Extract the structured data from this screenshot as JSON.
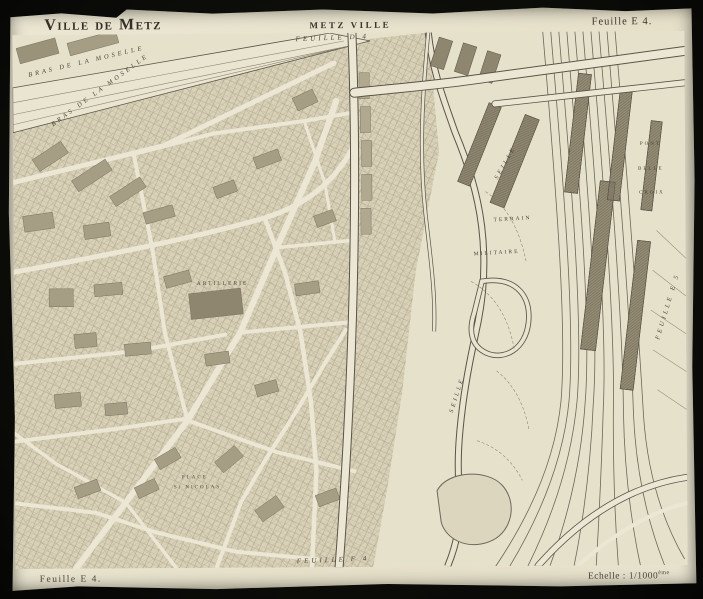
{
  "header": {
    "title_left": "Ville de Metz",
    "title_center": "METZ VILLE",
    "sheet_right": "Feuille E 4."
  },
  "footer": {
    "sheet_left": "Feuille E 4.",
    "scale_label": "Echelle : 1/1000",
    "scale_sup": "ème"
  },
  "map": {
    "labels": {
      "adjacent_sheet_top": "FEUILLE  D 4",
      "adjacent_sheet_right": "FEUILLE  E 5",
      "adjacent_sheet_bottom": "FEUILLE  F 4",
      "moselle_upper": "BRAS  DE  LA  MOSELLE",
      "moselle_lower": "BRAS  DE  LA  MOSELLE",
      "seille_upper": "SEILLE",
      "seille_lower": "SEILLE",
      "terrain_word1": "TERRAIN",
      "terrain_word2": "MILITAIRE",
      "pont": "PONT",
      "belle": "BELLE",
      "croix": "CROIX",
      "artillerie": "ARTILLERIE",
      "place": "PLACE",
      "st_nicolas": "St NICOLAS"
    },
    "colors": {
      "paper": "#e9e4cf",
      "ink": "#47413a",
      "block_light": "#d8d1b8",
      "building_dark": "#8e866f",
      "road": "#ece7d4",
      "water_outline": "#5a5448",
      "photo_background": "#0d0d0b"
    }
  }
}
